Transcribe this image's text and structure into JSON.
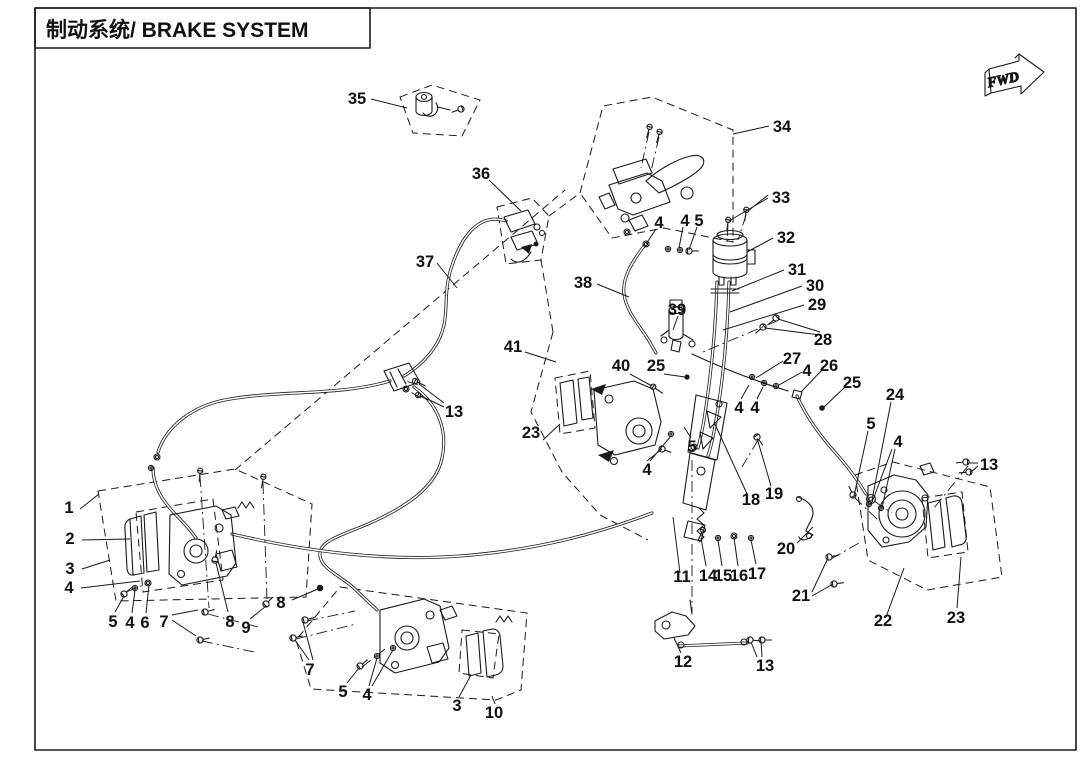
{
  "title": {
    "text": "制动系统/ BRAKE SYSTEM"
  },
  "direction_indicator": {
    "label": "FWD"
  },
  "colors": {
    "ink": "#1a1a1a",
    "background": "#ffffff"
  },
  "parts": [
    {
      "n": "1",
      "x": 69,
      "y": 513
    },
    {
      "n": "2",
      "x": 70,
      "y": 544
    },
    {
      "n": "3",
      "x": 70,
      "y": 574
    },
    {
      "n": "4",
      "x": 69,
      "y": 593
    },
    {
      "n": "5",
      "x": 113,
      "y": 627
    },
    {
      "n": "4",
      "x": 130,
      "y": 628
    },
    {
      "n": "6",
      "x": 145,
      "y": 628
    },
    {
      "n": "7",
      "x": 164,
      "y": 627
    },
    {
      "n": "8",
      "x": 230,
      "y": 627
    },
    {
      "n": "9",
      "x": 246,
      "y": 633
    },
    {
      "n": "8",
      "x": 281,
      "y": 608
    },
    {
      "n": "7",
      "x": 310,
      "y": 675
    },
    {
      "n": "5",
      "x": 343,
      "y": 697
    },
    {
      "n": "4",
      "x": 367,
      "y": 700
    },
    {
      "n": "3",
      "x": 457,
      "y": 711
    },
    {
      "n": "10",
      "x": 494,
      "y": 718
    },
    {
      "n": "13",
      "x": 454,
      "y": 417
    },
    {
      "n": "37",
      "x": 425,
      "y": 267
    },
    {
      "n": "35",
      "x": 357,
      "y": 104
    },
    {
      "n": "36",
      "x": 481,
      "y": 179
    },
    {
      "n": "34",
      "x": 782,
      "y": 132
    },
    {
      "n": "33",
      "x": 781,
      "y": 203
    },
    {
      "n": "32",
      "x": 786,
      "y": 243
    },
    {
      "n": "31",
      "x": 797,
      "y": 275
    },
    {
      "n": "30",
      "x": 815,
      "y": 291
    },
    {
      "n": "29",
      "x": 817,
      "y": 310
    },
    {
      "n": "28",
      "x": 823,
      "y": 345
    },
    {
      "n": "39",
      "x": 677,
      "y": 315
    },
    {
      "n": "38",
      "x": 583,
      "y": 288
    },
    {
      "n": "4",
      "x": 659,
      "y": 228
    },
    {
      "n": "4",
      "x": 685,
      "y": 226
    },
    {
      "n": "5",
      "x": 699,
      "y": 226
    },
    {
      "n": "41",
      "x": 513,
      "y": 352
    },
    {
      "n": "40",
      "x": 621,
      "y": 371
    },
    {
      "n": "25",
      "x": 656,
      "y": 371
    },
    {
      "n": "23",
      "x": 531,
      "y": 438
    },
    {
      "n": "4",
      "x": 647,
      "y": 475
    },
    {
      "n": "5",
      "x": 692,
      "y": 452
    },
    {
      "n": "18",
      "x": 751,
      "y": 505
    },
    {
      "n": "19",
      "x": 774,
      "y": 499
    },
    {
      "n": "4",
      "x": 739,
      "y": 413
    },
    {
      "n": "4",
      "x": 755,
      "y": 413
    },
    {
      "n": "27",
      "x": 792,
      "y": 364
    },
    {
      "n": "4",
      "x": 807,
      "y": 376
    },
    {
      "n": "26",
      "x": 829,
      "y": 371
    },
    {
      "n": "25",
      "x": 852,
      "y": 388
    },
    {
      "n": "24",
      "x": 895,
      "y": 400
    },
    {
      "n": "5",
      "x": 871,
      "y": 429
    },
    {
      "n": "4",
      "x": 898,
      "y": 447
    },
    {
      "n": "13",
      "x": 989,
      "y": 470
    },
    {
      "n": "20",
      "x": 786,
      "y": 554
    },
    {
      "n": "21",
      "x": 801,
      "y": 601
    },
    {
      "n": "22",
      "x": 883,
      "y": 626
    },
    {
      "n": "23",
      "x": 956,
      "y": 623
    },
    {
      "n": "11",
      "x": 682,
      "y": 582
    },
    {
      "n": "14",
      "x": 708,
      "y": 581
    },
    {
      "n": "15",
      "x": 723,
      "y": 581
    },
    {
      "n": "16",
      "x": 739,
      "y": 581
    },
    {
      "n": "17",
      "x": 757,
      "y": 579
    },
    {
      "n": "12",
      "x": 683,
      "y": 667
    },
    {
      "n": "13",
      "x": 765,
      "y": 671
    }
  ]
}
